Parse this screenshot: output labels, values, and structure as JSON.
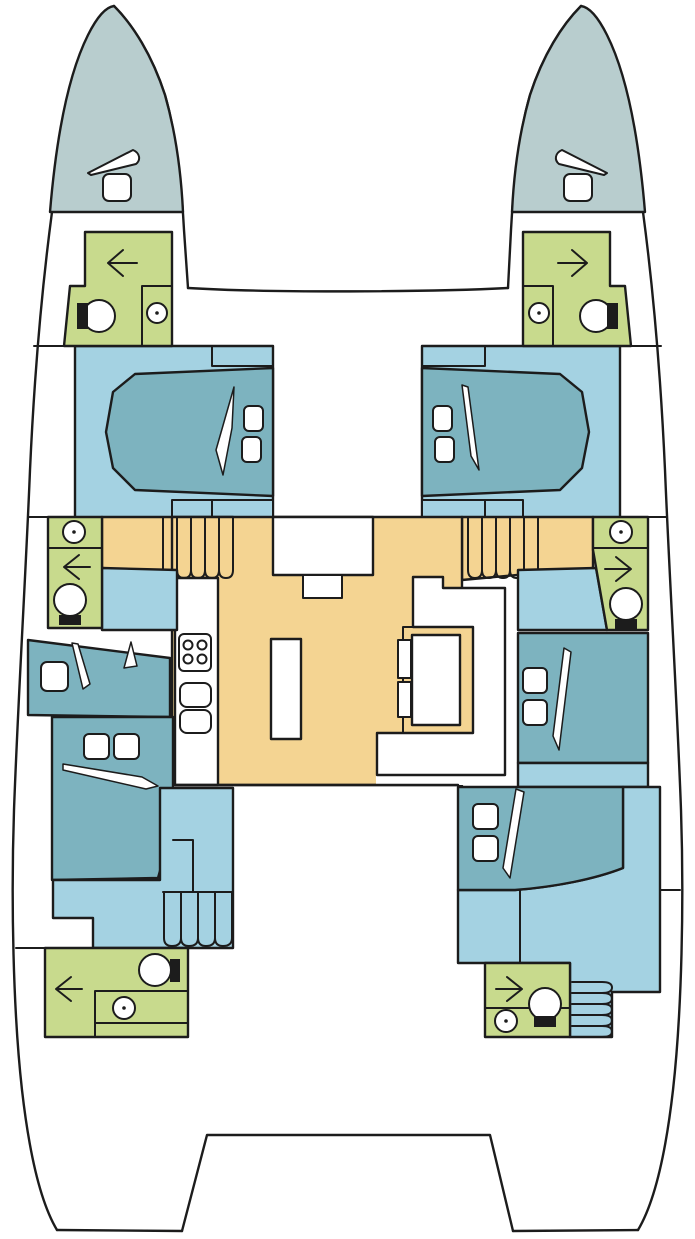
{
  "diagram": {
    "type": "catamaran-deck-plan",
    "description": "Top-down interior layout plan of a four-cabin sailing catamaran, bow up: twin hulls with cabins and heads, central salon with galley and dinette, forward trampoline beams and aft platform"
  },
  "colors": {
    "line": "#1c1c1c",
    "paper": "#ffffff",
    "deck": "#b8cdce",
    "floor": "#a4d2e2",
    "bed": "#7db3bf",
    "head": "#c8da8d",
    "salon": "#f4d492"
  },
  "legend": {
    "rooms": [
      {
        "id": "port-bow-deck",
        "label": "Port bow deck"
      },
      {
        "id": "stbd-bow-deck",
        "label": "Starboard bow deck"
      },
      {
        "id": "port-forward-head",
        "label": "Port forward head"
      },
      {
        "id": "stbd-forward-head",
        "label": "Starboard forward head"
      },
      {
        "id": "port-forward-cabin",
        "label": "Port forward cabin"
      },
      {
        "id": "stbd-forward-cabin",
        "label": "Starboard forward cabin"
      },
      {
        "id": "port-mid-head",
        "label": "Port midship head"
      },
      {
        "id": "stbd-mid-head",
        "label": "Starboard midship head"
      },
      {
        "id": "port-mid-cabin",
        "label": "Port midship cabin"
      },
      {
        "id": "stbd-mid-cabin",
        "label": "Starboard midship cabin"
      },
      {
        "id": "port-aft-cabin",
        "label": "Port aft cabin"
      },
      {
        "id": "stbd-aft-cabin",
        "label": "Starboard aft cabin"
      },
      {
        "id": "port-aft-head",
        "label": "Port aft head"
      },
      {
        "id": "stbd-aft-head",
        "label": "Starboard aft head"
      },
      {
        "id": "salon",
        "label": "Salon with galley and dinette"
      },
      {
        "id": "aft-platform",
        "label": "Aft platform"
      }
    ]
  },
  "fixtures": {
    "berths": 6,
    "pillows": 11,
    "toilets": 6,
    "wash_basins": 6,
    "shower_arrows": 6,
    "galley_burners": 4,
    "galley_sinks": 2,
    "deck_hatches": 2,
    "companionway_stairs": 4
  }
}
